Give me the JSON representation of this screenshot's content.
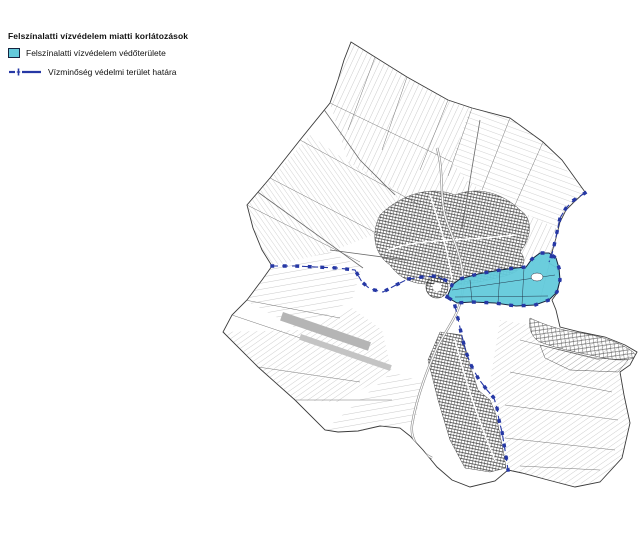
{
  "legend": {
    "title": "Felszínalatti vízvédelem miatti korlátozások",
    "items": [
      {
        "symbol": "protected-area-swatch",
        "label": "Felszínalatti vízvédelem védőterülete"
      },
      {
        "symbol": "boundary-line-symbol",
        "label": "Vízminőség védelmi terület határa"
      }
    ]
  },
  "colors": {
    "protected_area_fill": "#63cadb",
    "protected_area_border": "#16233f",
    "boundary_line": "#2638a5",
    "map_line": "#3a3a3a",
    "runway_gray": "#b5b5b5",
    "background": "#ffffff"
  }
}
